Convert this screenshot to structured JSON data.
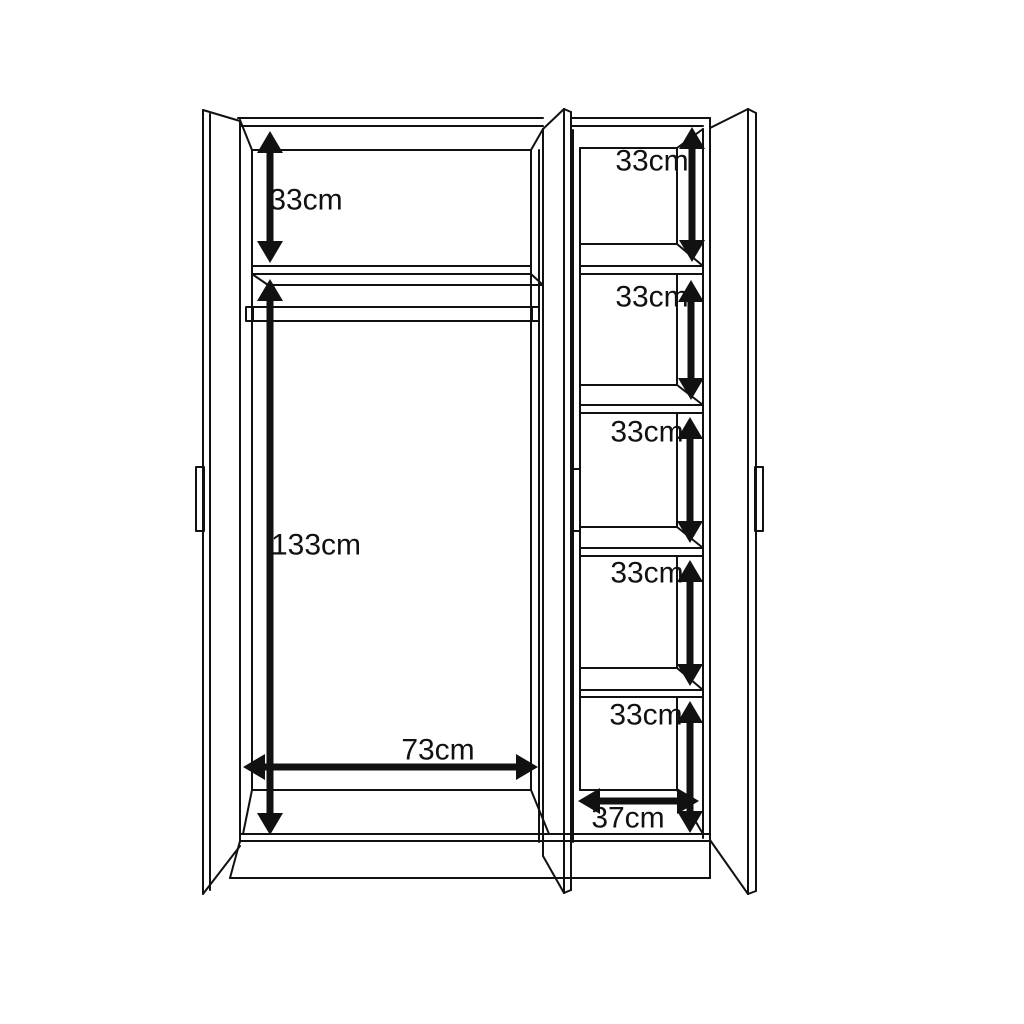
{
  "canvas": {
    "width": 1024,
    "height": 1024,
    "background": "#ffffff",
    "line_color": "#111111",
    "text_color": "#111111"
  },
  "diagram": {
    "dimensions": [
      {
        "id": "left-top-shelf-height",
        "label": "33cm",
        "orientation": "vertical",
        "x": 270,
        "y1": 131,
        "y2": 263,
        "label_x": 306,
        "label_y": 200
      },
      {
        "id": "left-hanging-height",
        "label": "133cm",
        "orientation": "vertical",
        "x": 270,
        "y1": 279,
        "y2": 835,
        "label_x": 316,
        "label_y": 545
      },
      {
        "id": "left-interior-width",
        "label": "73cm",
        "orientation": "horizontal",
        "y": 767,
        "x1": 243,
        "x2": 538,
        "label_x": 438,
        "label_y": 750
      },
      {
        "id": "right-shelf-width",
        "label": "37cm",
        "orientation": "horizontal",
        "y": 801,
        "x1": 578,
        "x2": 699,
        "label_x": 628,
        "label_y": 818
      },
      {
        "id": "right-shelf-1-height",
        "label": "33cm",
        "orientation": "vertical",
        "x": 692,
        "y1": 127,
        "y2": 262,
        "label_x": 652,
        "label_y": 161
      },
      {
        "id": "right-shelf-2-height",
        "label": "33cm",
        "orientation": "vertical",
        "x": 691,
        "y1": 280,
        "y2": 400,
        "label_x": 652,
        "label_y": 297
      },
      {
        "id": "right-shelf-3-height",
        "label": "33cm",
        "orientation": "vertical",
        "x": 690,
        "y1": 417,
        "y2": 543,
        "label_x": 647,
        "label_y": 432
      },
      {
        "id": "right-shelf-4-height",
        "label": "33cm",
        "orientation": "vertical",
        "x": 690,
        "y1": 560,
        "y2": 686,
        "label_x": 647,
        "label_y": 573
      },
      {
        "id": "right-shelf-5-height",
        "label": "33cm",
        "orientation": "vertical",
        "x": 690,
        "y1": 701,
        "y2": 833,
        "label_x": 646,
        "label_y": 715
      }
    ]
  }
}
